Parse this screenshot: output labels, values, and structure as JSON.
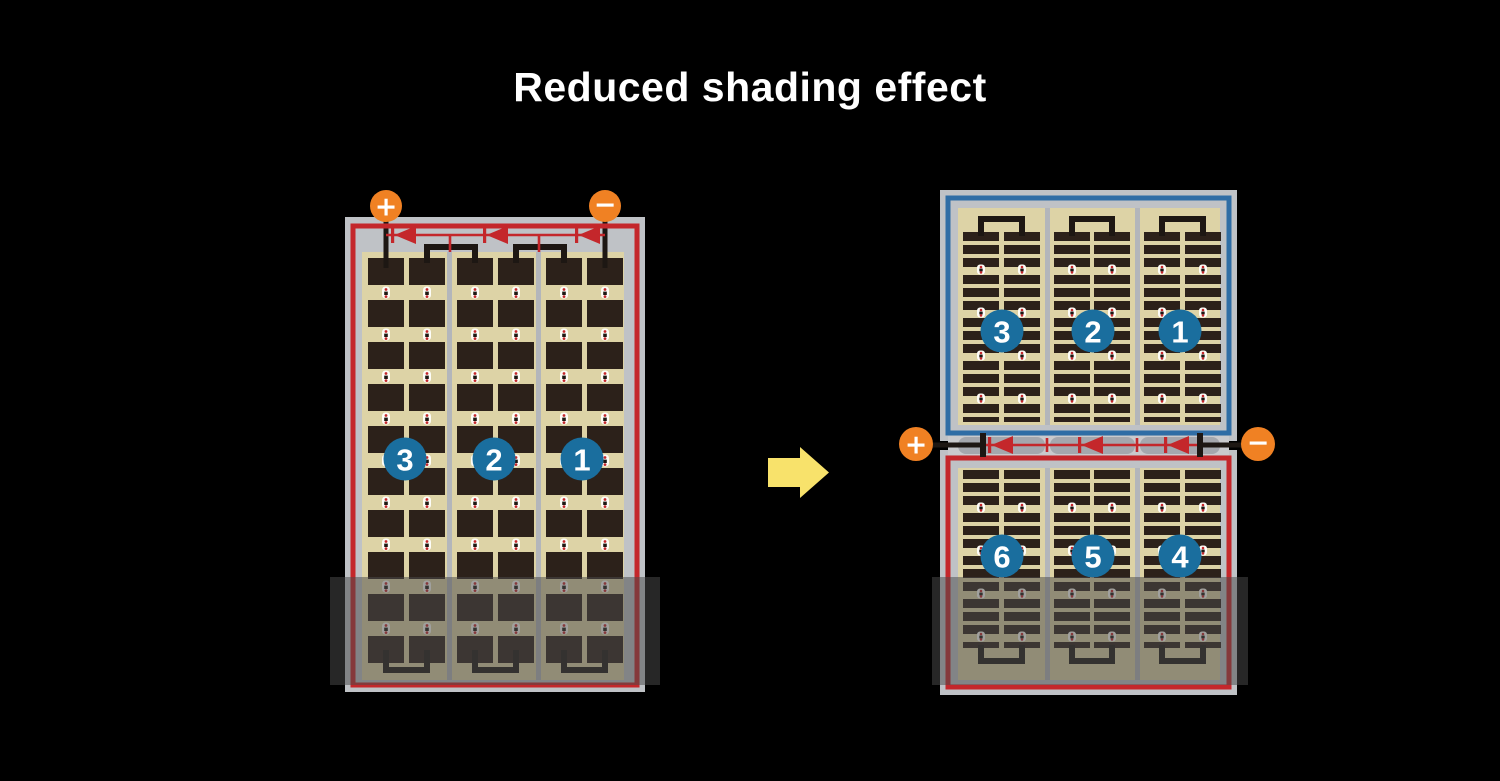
{
  "title": "Reduced shading effect",
  "before_module": {
    "terminals": {
      "plus": "+",
      "minus": "−"
    },
    "string_labels": [
      "3",
      "2",
      "1"
    ]
  },
  "after_module": {
    "terminals": {
      "plus": "+",
      "minus": "−"
    },
    "top_string_labels": [
      "3",
      "2",
      "1"
    ],
    "bottom_string_labels": [
      "6",
      "5",
      "4"
    ]
  },
  "colors": {
    "background": "#000000",
    "title_text": "#ffffff",
    "panel_frame_gray": "#bfc2c6",
    "cell_area_tan": "#ddd3a6",
    "cell_dark": "#2c211a",
    "wire_black": "#1d1713",
    "circuit_red": "#c4272b",
    "circuit_blue": "#2f6da5",
    "string_badge_blue": "#1a6e9e",
    "terminal_orange": "#f08123",
    "arrow_yellow": "#f8e26b",
    "shade_overlay": "rgba(75,75,75,0.52)"
  }
}
